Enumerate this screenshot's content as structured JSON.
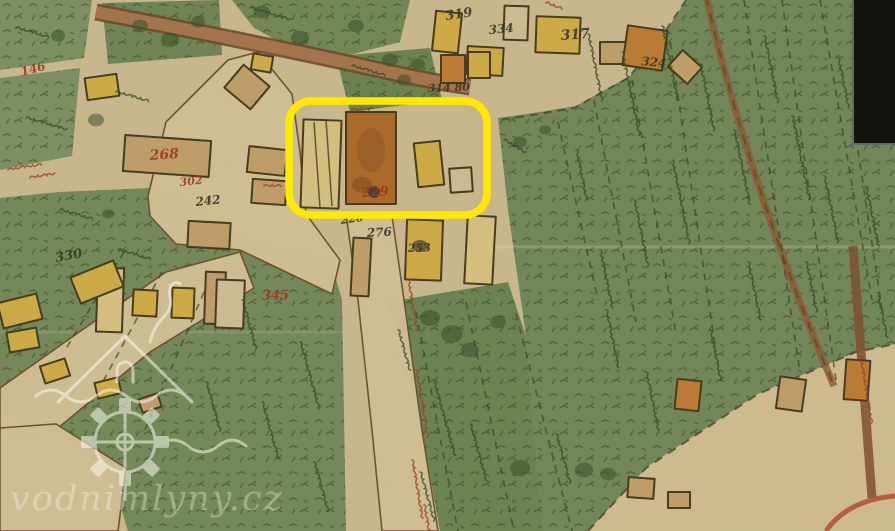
{
  "title": "historical cadastral map with highlighted mill plot",
  "watermark": {
    "text": "vodnimlyny.cz"
  },
  "highlight": {
    "shape": "rounded-rectangle",
    "color": "#ffe903",
    "x": 289,
    "y": 101,
    "width": 198,
    "height": 114
  },
  "palette": {
    "parchment": "#cdbc92",
    "field_green": "#6f8757",
    "building_wood_yellow": "#d2ae44",
    "building_masonry_orange": "#bf7b33",
    "road_brown": "#a5734d",
    "number_red": "#9e3017",
    "number_black": "#2c2d1f",
    "sheet_void": "#12150f"
  },
  "map_labels": [
    {
      "text": "146",
      "x": 22,
      "y": 76,
      "rot": -15,
      "size": 12,
      "color": "red"
    },
    {
      "text": "268",
      "x": 150,
      "y": 160,
      "rot": -4,
      "size": 14,
      "color": "red"
    },
    {
      "text": "302",
      "x": 180,
      "y": 186,
      "rot": -6,
      "size": 11,
      "color": "red"
    },
    {
      "text": "345",
      "x": 262,
      "y": 300,
      "rot": -2,
      "size": 13,
      "color": "red"
    },
    {
      "text": "229",
      "x": 362,
      "y": 197,
      "rot": -4,
      "size": 13,
      "color": "red"
    },
    {
      "text": "319",
      "x": 446,
      "y": 20,
      "rot": -8,
      "size": 13,
      "color": "black"
    },
    {
      "text": "334",
      "x": 489,
      "y": 34,
      "rot": -5,
      "size": 12,
      "color": "black"
    },
    {
      "text": "317",
      "x": 561,
      "y": 40,
      "rot": -4,
      "size": 14,
      "color": "black"
    },
    {
      "text": "324",
      "x": 641,
      "y": 65,
      "rot": 6,
      "size": 12,
      "color": "black"
    },
    {
      "text": "314 80",
      "x": 428,
      "y": 92,
      "rot": -2,
      "size": 11,
      "color": "black"
    },
    {
      "text": "330",
      "x": 56,
      "y": 262,
      "rot": -10,
      "size": 13,
      "color": "black"
    },
    {
      "text": "242",
      "x": 196,
      "y": 206,
      "rot": -6,
      "size": 12,
      "color": "black"
    },
    {
      "text": "226",
      "x": 341,
      "y": 224,
      "rot": -8,
      "size": 11,
      "color": "black"
    },
    {
      "text": "276",
      "x": 367,
      "y": 237,
      "rot": -3,
      "size": 12,
      "color": "black"
    },
    {
      "text": "253",
      "x": 408,
      "y": 252,
      "rot": -2,
      "size": 11,
      "color": "black"
    }
  ]
}
